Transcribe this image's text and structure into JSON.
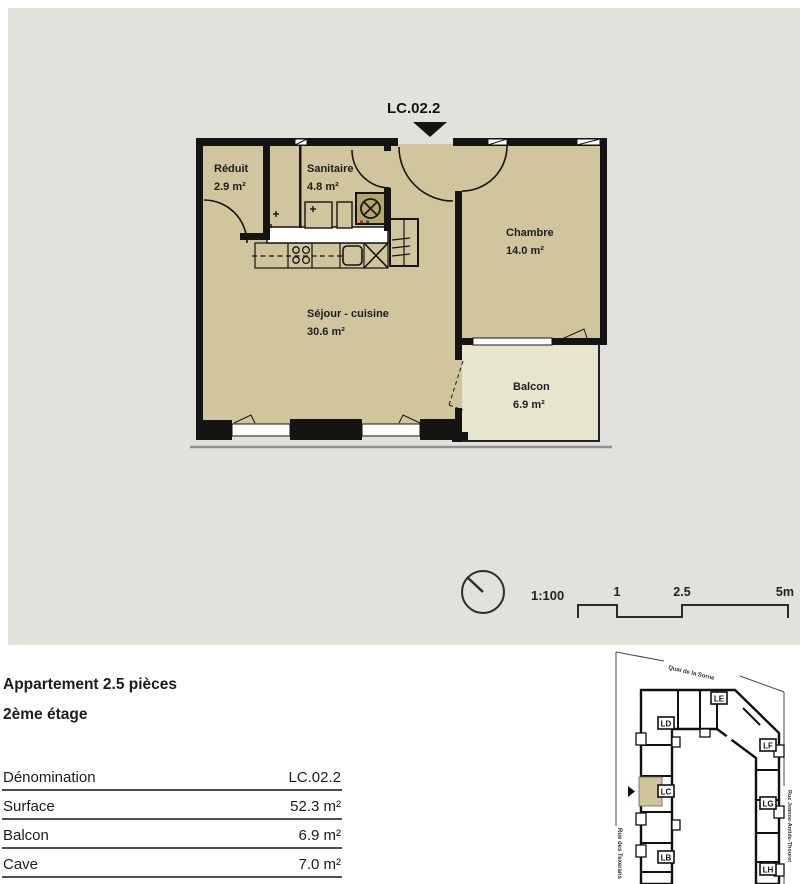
{
  "plan": {
    "unit_label": "LC.02.2",
    "rooms": {
      "reduit": {
        "name": "Réduit",
        "area": "2.9 m²"
      },
      "sanitaire": {
        "name": "Sanitaire",
        "area": "4.8 m²"
      },
      "chambre": {
        "name": "Chambre",
        "area": "14.0 m²"
      },
      "sejour": {
        "name": "Séjour - cuisine",
        "area": "30.6 m²"
      },
      "balcon": {
        "name": "Balcon",
        "area": "6.9 m²"
      }
    },
    "scale": {
      "ratio": "1:100",
      "tick1": "1",
      "tick2": "2.5",
      "tick3": "5m"
    },
    "colors": {
      "room_fill": "#d0c59c",
      "balcony_fill": "#e6e6cf",
      "wall": "#141414",
      "background": "#e3e1dc"
    }
  },
  "info": {
    "title_line1": "Appartement 2.5 pièces",
    "title_line2": "2ème étage",
    "table": [
      {
        "label": "Dénomination",
        "value": "LC.02.2"
      },
      {
        "label": "Surface",
        "value": "52.3 m²"
      },
      {
        "label": "Balcon",
        "value": "6.9 m²"
      },
      {
        "label": "Cave",
        "value": "7.0 m²"
      }
    ]
  },
  "site_plan": {
    "units": {
      "le": "LE",
      "ld": "LD",
      "lf": "LF",
      "lc": "LC",
      "lg": "LG",
      "lb": "LB",
      "lh": "LH"
    },
    "highlighted_unit": "LC",
    "streets": {
      "top": "Quai de la Sorne",
      "left": "Rue des Texerans",
      "right": "Rue Jeanne-Antide-Thouret"
    }
  }
}
